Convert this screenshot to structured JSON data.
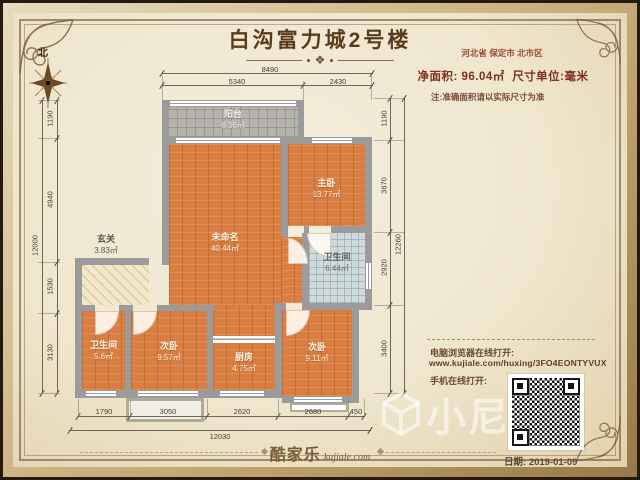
{
  "title": "白沟富力城2号楼",
  "compass": {
    "north": "北"
  },
  "info": {
    "location": "河北省 保定市 北市区",
    "net_area_label": "净面积:",
    "net_area_value": "96.04㎡",
    "unit_label": "尺寸单位:毫米",
    "note": "注:准确面积请以实际尺寸为准",
    "pc_open_label": "电脑浏览器在线打开:",
    "url": "www.kujiale.com/huxing/3FO4EONTYVUX",
    "mobile_open_label": "手机在线打开:",
    "date_label": "日期:",
    "date_value": "2019-01-09"
  },
  "rooms": {
    "balcony": {
      "name": "阳台",
      "area": "6.36㎡"
    },
    "living": {
      "name": "未命名",
      "area": "40.44㎡"
    },
    "master": {
      "name": "主卧",
      "area": "13.77㎡"
    },
    "bath_main": {
      "name": "卫生间",
      "area": "6.44㎡"
    },
    "entry": {
      "name": "玄关",
      "area": "3.83㎡"
    },
    "bath_small": {
      "name": "卫生间",
      "area": "5.6㎡"
    },
    "bedroom2": {
      "name": "次卧",
      "area": "9.57㎡"
    },
    "kitchen": {
      "name": "厨房",
      "area": "4.75㎡"
    },
    "bedroom3": {
      "name": "次卧",
      "area": "9.11㎡"
    }
  },
  "dimensions": {
    "top": {
      "total": "8490",
      "segments": [
        "5340",
        "2430"
      ]
    },
    "left": {
      "total": "12000",
      "segments": [
        "1190",
        "4940",
        "1530",
        "3130"
      ]
    },
    "right": {
      "total": "12260",
      "segments": [
        "1190",
        "3670",
        "2920",
        "3400"
      ]
    },
    "bottom": {
      "total": "12030",
      "segments": [
        "1790",
        "3050",
        "2620",
        "2680",
        "450"
      ]
    }
  },
  "footer": {
    "brand": "酷家乐",
    "brand_site": "kujiale.com"
  },
  "watermark": {
    "text": "小尼"
  },
  "colors": {
    "wood": "#d97e42",
    "wall": "#9b9b9b",
    "accent_red": "#8d3b2b",
    "frame_gold": "#c9b184",
    "paper": "#efe6cd"
  }
}
